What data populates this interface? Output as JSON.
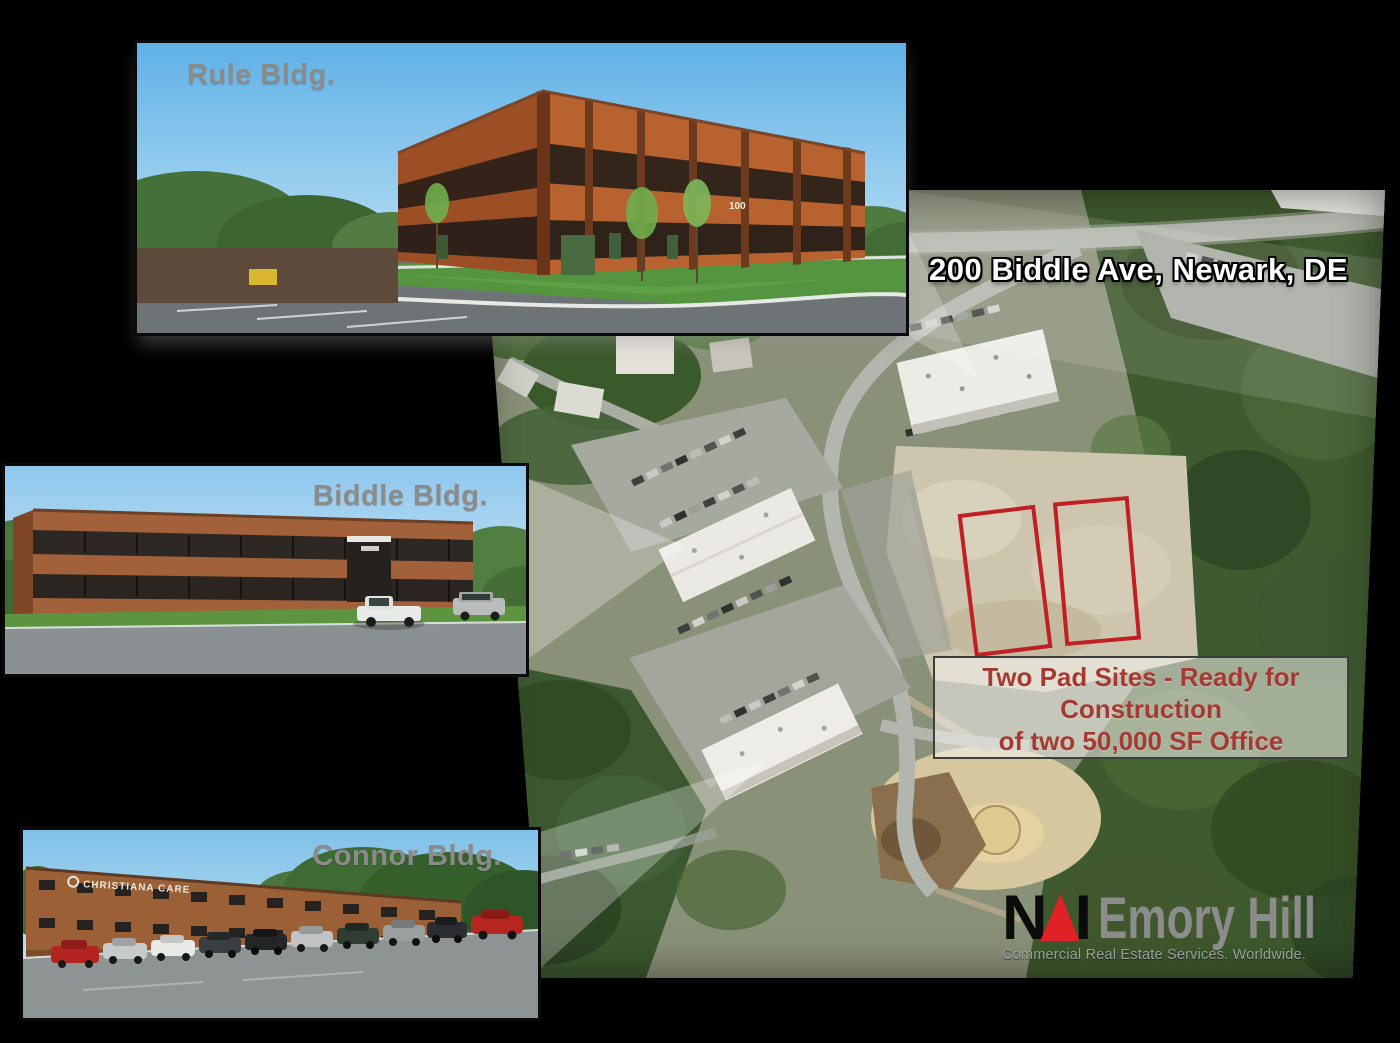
{
  "page": {
    "background": "#000000"
  },
  "photos": {
    "rule": {
      "label": "Rule Bldg.",
      "building_number": "100"
    },
    "biddle": {
      "label": "Biddle Bldg."
    },
    "connor": {
      "label": "Connor Bldg.",
      "building_sign": "CHRISTIANA CARE"
    }
  },
  "aerial": {
    "address_overlay": "200 Biddle Ave, Newark, DE",
    "pad_note_line1": "Two Pad Sites - Ready for",
    "pad_note_line2": "Construction",
    "pad_note_line3": "of two 50,000 SF Office"
  },
  "logo": {
    "letter_n": "N",
    "letter_a": "A",
    "letter_i": "I",
    "company": "Emory Hill",
    "tagline": "Commercial Real Estate Services. Worldwide."
  },
  "colors": {
    "pad_outline": "#c01f24",
    "pad_note_text": "#a63a32",
    "pad_note_border": "#3c403c",
    "photo_label_gray": "#8b8b8b",
    "address_text": "#ffffff",
    "logo_black": "#0c0c0c",
    "logo_red": "#e02127",
    "logo_gray": "#8c8c8c",
    "tagline_gray": "#95a19b"
  }
}
